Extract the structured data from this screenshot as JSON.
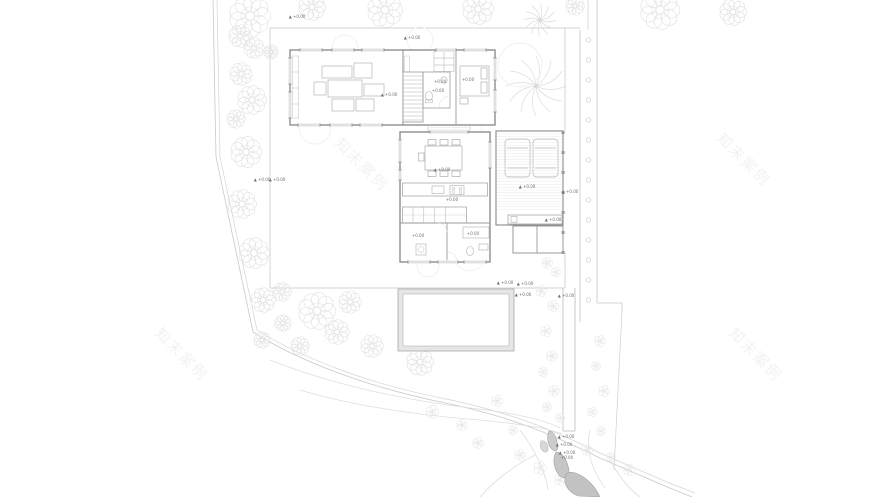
{
  "page": {
    "type": "architectural-site-plan",
    "floor": "first-floor-plan"
  },
  "watermark": {
    "text": "知末案例",
    "color": "rgba(0,0,0,0.055)",
    "font_size": 15,
    "rotation_deg": 45,
    "positions": [
      {
        "x": 358,
        "y": 168
      },
      {
        "x": 740,
        "y": 163
      },
      {
        "x": 178,
        "y": 358
      },
      {
        "x": 752,
        "y": 358
      }
    ]
  },
  "colors": {
    "wall": "#858585",
    "partition": "#9a9a9a",
    "furniture": "#b5b5b5",
    "site_line": "#c6c6c6",
    "terrace_line": "#c4c4c4",
    "vegetation": "#e2e2e2",
    "hatch": "#e3e3e3",
    "annotation": "#6f6f6f",
    "rock_fill": "#c6c6c6",
    "rock_stroke": "#a3a3a3",
    "pool_band": "#e6e6e6"
  },
  "annotations": [
    {
      "x": 297,
      "y": 18,
      "t": "▲ +0.00"
    },
    {
      "x": 412,
      "y": 39,
      "t": "▲ +0.00"
    },
    {
      "x": 389,
      "y": 96,
      "t": "▲ +0.00"
    },
    {
      "x": 440,
      "y": 83,
      "t": "+0.00"
    },
    {
      "x": 468,
      "y": 81,
      "t": "+0.00"
    },
    {
      "x": 438,
      "y": 92,
      "t": "+0.00"
    },
    {
      "x": 442,
      "y": 171,
      "t": "▲ +0.00"
    },
    {
      "x": 452,
      "y": 201,
      "t": "+0.00"
    },
    {
      "x": 418,
      "y": 237,
      "t": "+0.00"
    },
    {
      "x": 473,
      "y": 235,
      "t": "+0.00"
    },
    {
      "x": 527,
      "y": 188,
      "t": "▲ +0.00"
    },
    {
      "x": 570,
      "y": 193,
      "t": "▲ +0.00"
    },
    {
      "x": 262,
      "y": 181,
      "t": "▲ +0.00"
    },
    {
      "x": 277,
      "y": 181,
      "t": "▲ +0.00"
    },
    {
      "x": 553,
      "y": 221,
      "t": "▲ +0.00"
    },
    {
      "x": 505,
      "y": 284,
      "t": "▲ +0.00"
    },
    {
      "x": 525,
      "y": 285,
      "t": "▲ +0.00"
    },
    {
      "x": 523,
      "y": 296,
      "t": "▲ +0.00"
    },
    {
      "x": 566,
      "y": 297,
      "t": "▲ +0.00"
    },
    {
      "x": 566,
      "y": 438,
      "t": "▲ +0.00"
    },
    {
      "x": 564,
      "y": 446,
      "t": "▲ +0.00"
    },
    {
      "x": 567,
      "y": 454,
      "t": "▲ +0.00"
    },
    {
      "x": 567,
      "y": 459,
      "t": "+0.00"
    }
  ]
}
